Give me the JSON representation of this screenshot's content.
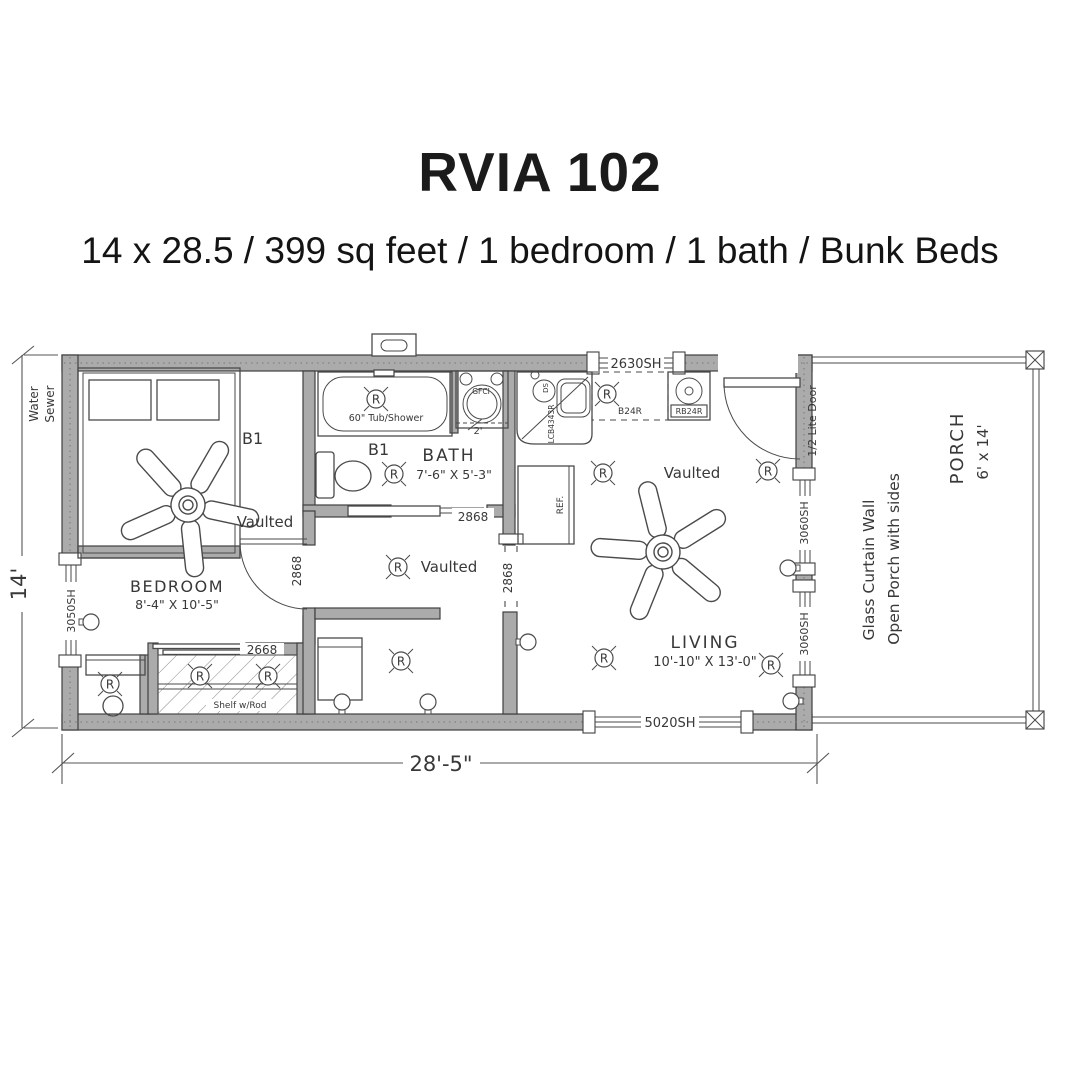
{
  "header": {
    "title": "RVIA 102",
    "subtitle": "14 x 28.5 / 399 sq feet / 1 bedroom / 1 bath / Bunk Beds"
  },
  "dims": {
    "width": "28'-5\"",
    "height": "14'"
  },
  "site": {
    "water": "Water",
    "sewer": "Sewer"
  },
  "rooms": {
    "bedroom": {
      "name": "BEDROOM",
      "size": "8'-4\" X 10'-5\"",
      "ceiling": "Vaulted",
      "b1": "B1"
    },
    "bath": {
      "name": "BATH",
      "size": "7'-6\" X 5'-3\"",
      "b1": "B1",
      "tub": "60\" Tub/Shower",
      "gfci": "GFCI",
      "depth": "2'"
    },
    "hall": {
      "ceiling": "Vaulted"
    },
    "living": {
      "name": "LIVING",
      "size": "10'-10\" X 13'-0\"",
      "ceiling": "Vaulted"
    },
    "porch": {
      "name": "PORCH",
      "size": "6' x 14'",
      "note1": "Glass Curtain Wall",
      "note2": "Open Porch with sides"
    },
    "closet": {
      "shelf": "Shelf w/Rod"
    }
  },
  "openings": {
    "win_left": "3050SH",
    "win_kitchen": "2630SH",
    "win_bottom": "5020SH",
    "win_porch1": "3060SH",
    "win_porch2": "3060SH",
    "door_bedroom": "2868",
    "door_bath": "2868",
    "opening_hall": "2868",
    "door_closet": "2668",
    "door_porch": "1/2 Lite Door"
  },
  "kitchen": {
    "corner_sink": "LCB4343R",
    "sink_note": "DS",
    "base_cab": "B24R",
    "range": "RB24R",
    "fridge": "REF."
  },
  "symbols": {
    "recessed_light": "R"
  }
}
